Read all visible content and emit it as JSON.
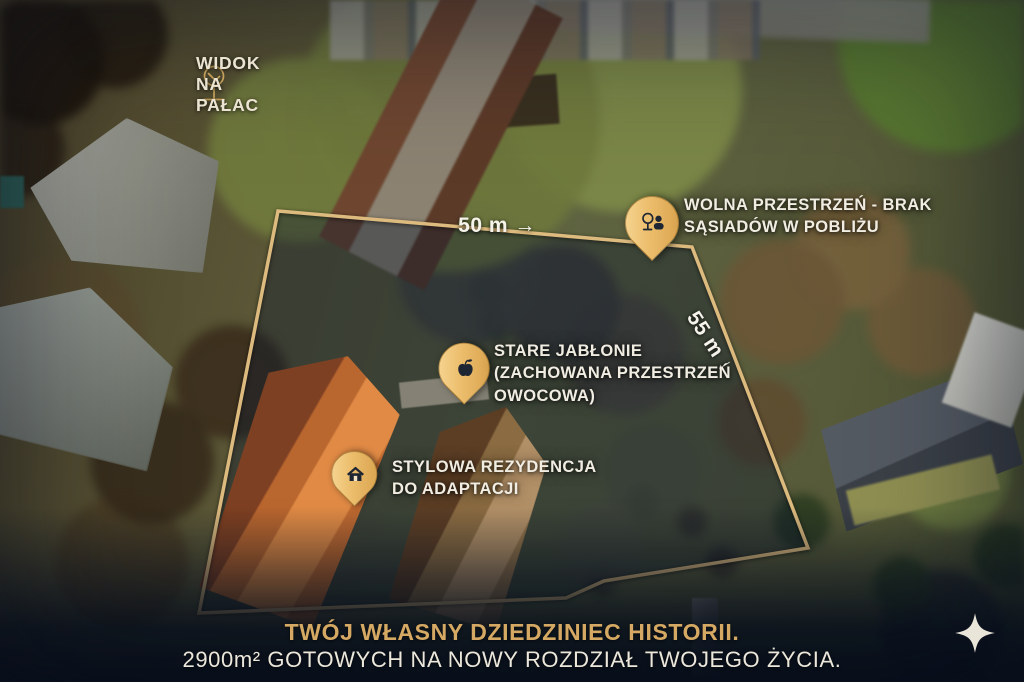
{
  "annotations": {
    "view_label": {
      "icon": "tree-icon",
      "text": "WIDOK NA PAŁAC"
    },
    "dimensions": {
      "top_edge": "50 m →",
      "right_edge": "55 m ↓"
    },
    "markers": [
      {
        "id": "open-space",
        "icon": "park-pin-icon",
        "lines": [
          "WOLNA PRZESTRZEŃ - BRAK",
          "SĄSIADÓW W POBLIŻU"
        ]
      },
      {
        "id": "orchard",
        "icon": "apple-pin-icon",
        "lines": [
          "STARE JABŁONIE",
          "(ZACHOWANA PRZESTRZEŃ",
          "OWOCOWA)"
        ]
      },
      {
        "id": "residence",
        "icon": "house-pin-icon",
        "lines": [
          "STYLOWA REZYDENCJA",
          "DO ADAPTACJI"
        ]
      }
    ]
  },
  "caption": {
    "headline": "TWÓJ WŁASNY DZIEDZINIEC HISTORII.",
    "subheadline": "2900m² GOTOWYCH NA NOWY ROZDZIAŁ TWOJEGO ŻYCIA."
  },
  "logo": {
    "icon": "sparkle-logo"
  },
  "colors": {
    "boundary_gold": "#ddba7e",
    "pin_gold": "#ecbe6d",
    "headline_gold": "#d5a963",
    "body_text_light": "#ece7db",
    "label_text": "#f1ede2",
    "overlay_navy": "#0d1b2e"
  }
}
